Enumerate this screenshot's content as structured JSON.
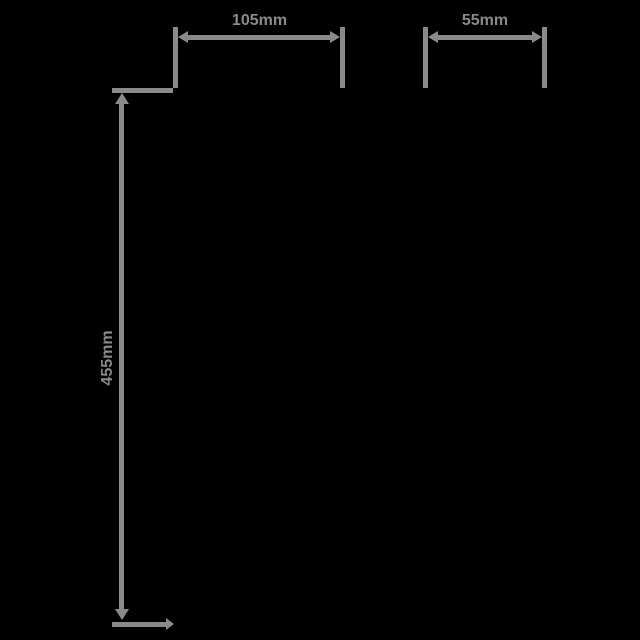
{
  "colors": {
    "bg": "#000000",
    "line": "#8a8a8a"
  },
  "diagram": {
    "type": "product-dimension-drawing",
    "units": "mm",
    "dimensions": {
      "top_width": {
        "label": "105mm"
      },
      "top_depth": {
        "label": "55mm"
      },
      "side_height": {
        "label": "455mm"
      }
    }
  }
}
